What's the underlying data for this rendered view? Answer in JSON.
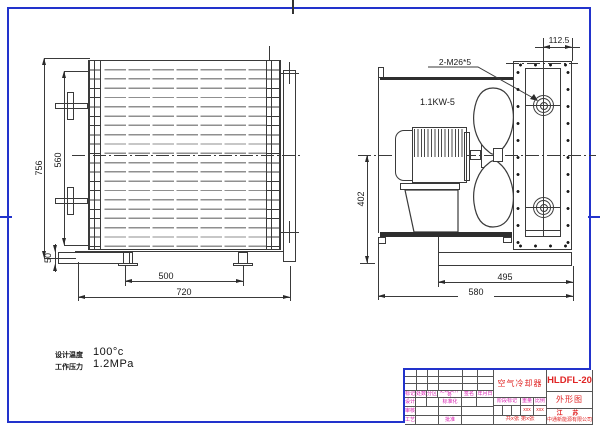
{
  "page": {
    "border_color": "#2233cc",
    "line_color": "#3a3a3a",
    "title_text_red": "#e02424",
    "title_text_magenta": "#d81bb0"
  },
  "front_view": {
    "dim_overall_height": "756",
    "dim_tube_height": "560",
    "dim_foot_height": "50",
    "dim_foot_spacing": "500",
    "dim_overall_width": "720"
  },
  "side_view": {
    "thread_callout": "2-M26*5",
    "motor_label": "1.1KW-5",
    "dim_center_height": "402",
    "dim_flange_offset": "112.5",
    "dim_base_width": "495",
    "dim_overall_depth": "580"
  },
  "specs": {
    "design_temp_label": "设计温度",
    "design_temp_value": "100°c",
    "working_pressure_label": "工作压力",
    "working_pressure_value": "1.2MPa"
  },
  "title_block": {
    "product_name": "空气冷却器",
    "model": "HLDFL-20",
    "view_name": "外形图",
    "company_line1": "江  苏",
    "company_line2": "中通新能源有限公司",
    "rev_headers": [
      "标记",
      "处数",
      "分区",
      "更改文件号",
      "签名",
      "年月日"
    ],
    "role_design": "设计",
    "role_standard": "标准化",
    "role_check": "审核",
    "role_process": "工艺",
    "role_approve": "批准",
    "stage_label": "阶段标记",
    "weight_label": "重量",
    "scale_label": "比例",
    "weight_value": "xxx",
    "scale_value": "xxx",
    "sheet_info": "共x张 第x张"
  }
}
